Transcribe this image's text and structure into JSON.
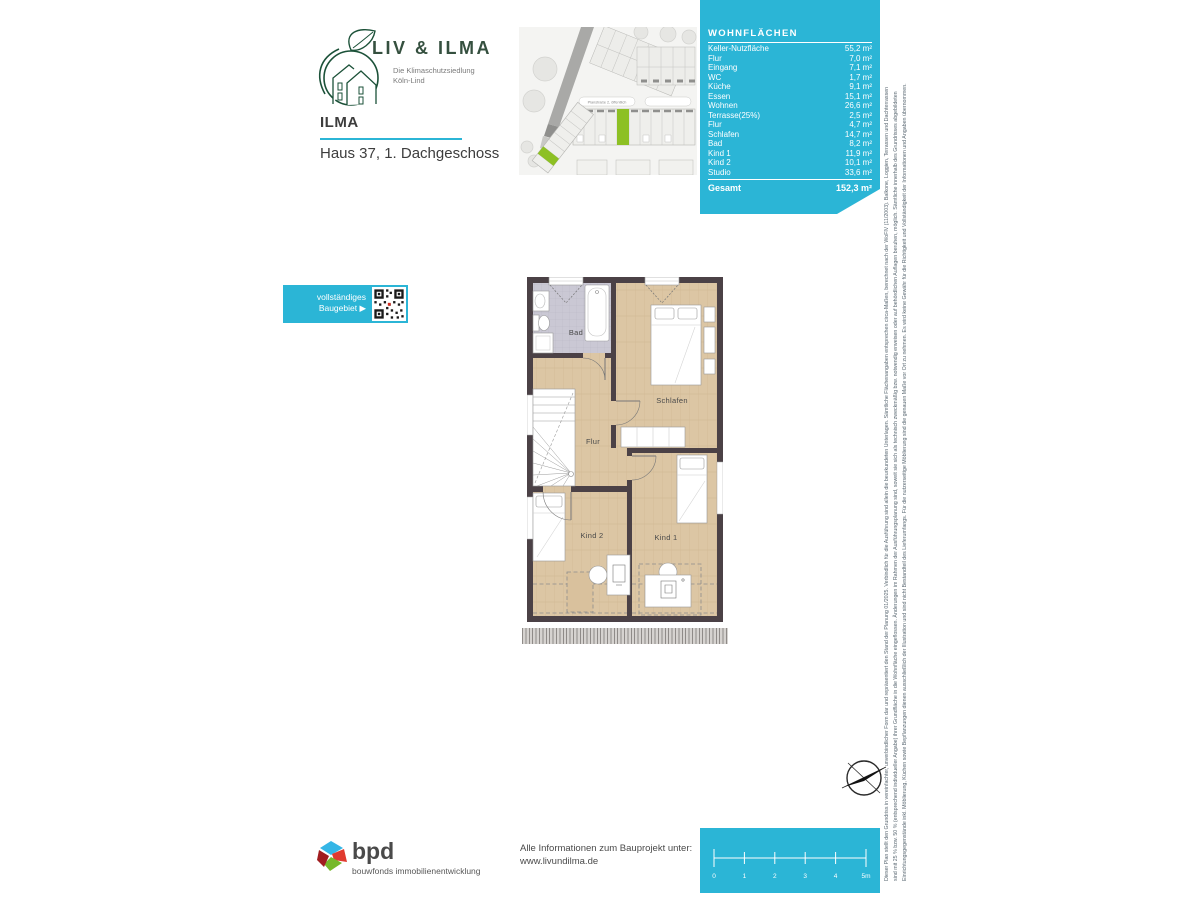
{
  "brand": {
    "name": "LIV & ILMA",
    "tagline_line1": "Die Klimaschutzsiedlung",
    "tagline_line2": "Köln-Lind"
  },
  "header": {
    "project": "ILMA",
    "subtitle": "Haus 37, 1. Dachgeschoss"
  },
  "siteplan": {
    "street_label": "Planstraße 2, öffentlich"
  },
  "wohnflaechen": {
    "title": "WOHNFLÄCHEN",
    "rows": [
      {
        "label": "Keller-Nutzfläche",
        "value": "55,2 m²"
      },
      {
        "label": "Flur",
        "value": "7,0 m²"
      },
      {
        "label": "Eingang",
        "value": "7,1 m²"
      },
      {
        "label": "WC",
        "value": "1,7 m²"
      },
      {
        "label": "Küche",
        "value": "9,1 m²"
      },
      {
        "label": "Essen",
        "value": "15,1 m²"
      },
      {
        "label": "Wohnen",
        "value": "26,6 m²"
      },
      {
        "label": "Terrasse(25%)",
        "value": "2,5 m²"
      },
      {
        "label": "Flur",
        "value": "4,7 m²"
      },
      {
        "label": "Schlafen",
        "value": "14,7 m²"
      },
      {
        "label": "Bad",
        "value": "8,2 m²"
      },
      {
        "label": "Kind 1",
        "value": "11,9 m²"
      },
      {
        "label": "Kind 2",
        "value": "10,1 m²"
      },
      {
        "label": "Studio",
        "value": "33,6 m²"
      }
    ],
    "total_label": "Gesamt",
    "total_value": "152,3 m²"
  },
  "qr": {
    "line1": "vollständiges",
    "line2": "Baugebiet ▶"
  },
  "floorplan": {
    "rooms": {
      "bad": "Bad",
      "schlafen": "Schlafen",
      "flur": "Flur",
      "kind2": "Kind 2",
      "kind1": "Kind 1"
    }
  },
  "disclaimer": {
    "line1": "Dieser Plan stellt den Grundriss in vereinfachter, unverbindlicher Form dar und repräsentiert den Stand der Planung 01/2025. Verbindlich für die Ausführung sind allein die beurkundeten Unterlagen. Sämtliche Flächenangaben entsprechen circa-Maßen, berechnet nach der WoFlV (11/2003). Balkone, Loggien, Terrassen und Dachterrassen",
    "line2": "sind mit 25 % bzw. 50 % (entsprechend individueller Angabe) ihrer Grundfläche in die Wohnfläche eingeflossen. Änderungen im Rahmen der Ausführungsplanung sind, soweit sie sich als technisch zweckmäßig bzw. notwendig erweisen oder auf behördlichen Auflagen beruhen, möglich. Sämtliche innerhalb des Grundrisses abgebildeten",
    "line3": "Einrichtungsgegenstände inkl. Möblierung, Küchen sowie Bepflanzungen dienen ausschließlich der Illustration und sind nicht Bestandteil des Lieferumfangs. Für die nutzerseitige Möblierung sind die genauen Maße vor Ort zu nehmen. Es wird keine Gewähr für die Richtigkeit und Vollständigkeit der Informationen und Angaben übernommen."
  },
  "footer": {
    "bpd": "bpd",
    "bpd_sub": "bouwfonds immobilienentwicklung",
    "info_line1": "Alle Informationen zum Bauprojekt unter:",
    "info_line2": "www.livundilma.de"
  },
  "scalebar": {
    "ticks": [
      "0",
      "1",
      "2",
      "3",
      "4",
      "5m"
    ]
  },
  "colors": {
    "cyan": "#2bb5d6",
    "highlight_green": "#8dc024",
    "logo_green": "#1b5138",
    "wall": "#4b4146"
  }
}
